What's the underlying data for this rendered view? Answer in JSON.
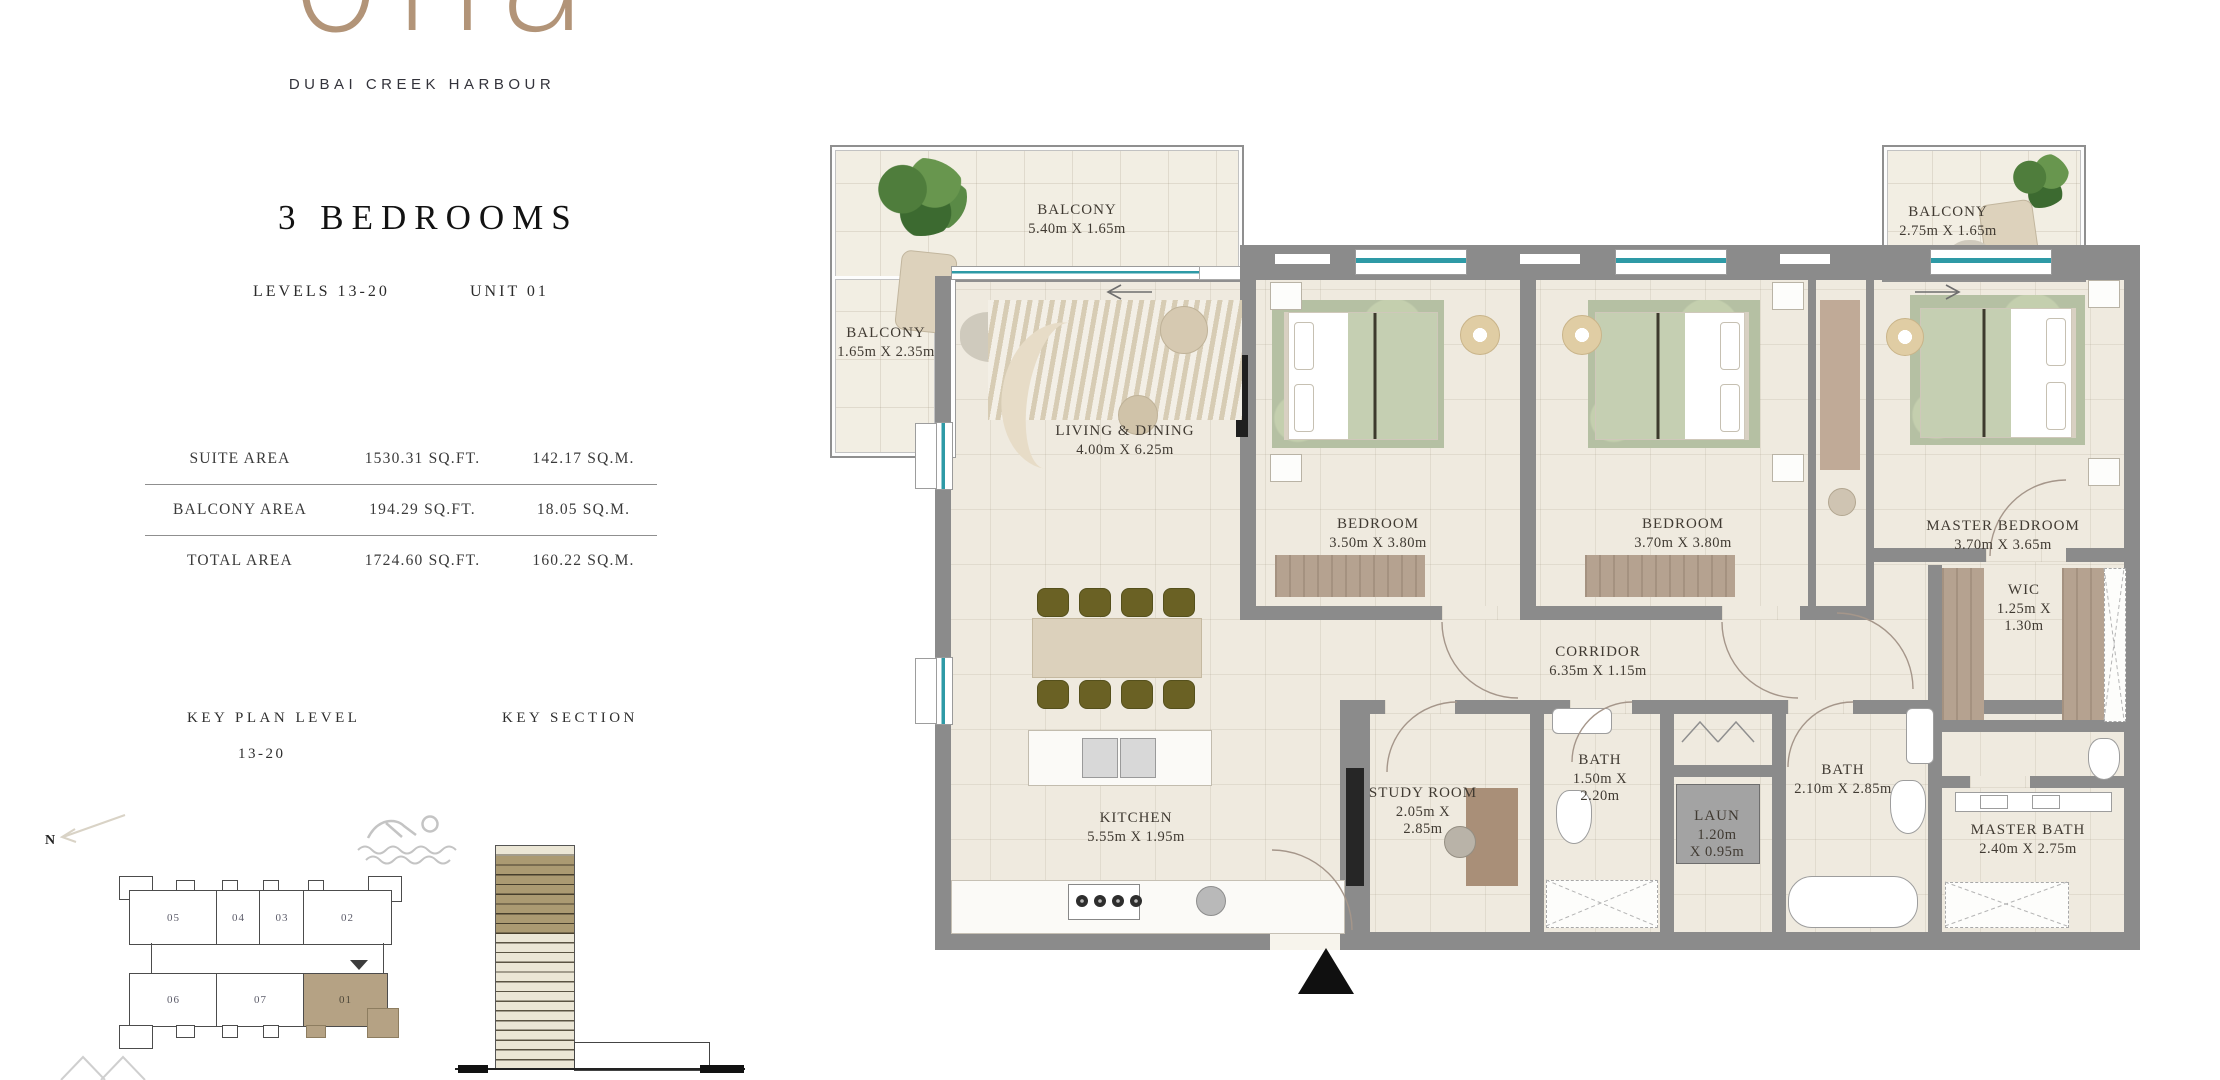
{
  "brand": {
    "logo_text": "ona",
    "subtitle": "DUBAI CREEK HARBOUR",
    "logo_color": "#b29478"
  },
  "unit_info": {
    "title": "3 BEDROOMS",
    "levels": "LEVELS 13-20",
    "unit": "UNIT 01"
  },
  "area_table": {
    "rows": [
      {
        "label": "SUITE AREA",
        "sqft": "1530.31 SQ.FT.",
        "sqm": "142.17 SQ.M."
      },
      {
        "label": "BALCONY AREA",
        "sqft": "194.29 SQ.FT.",
        "sqm": "18.05 SQ.M."
      },
      {
        "label": "TOTAL AREA",
        "sqft": "1724.60 SQ.FT.",
        "sqm": "160.22 SQ.M."
      }
    ]
  },
  "key_plan": {
    "title": "KEY PLAN LEVEL",
    "level_range": "13-20",
    "units": [
      "05",
      "04",
      "03",
      "02",
      "06",
      "07",
      "01"
    ],
    "highlighted_unit": "01",
    "highlight_color": "#b5a284"
  },
  "key_section": {
    "title": "KEY SECTION",
    "highlight_color": "#ab9a72"
  },
  "compass": {
    "north_label": "N"
  },
  "floorplan": {
    "wall_color": "#8b8b8b",
    "glazing_color": "#2e9aa6",
    "rooms": {
      "balcony_main": {
        "name": "BALCONY",
        "dims": "5.40m X 1.65m"
      },
      "balcony_side": {
        "name": "BALCONY",
        "dims": "1.65m X 2.35m"
      },
      "balcony_master": {
        "name": "BALCONY",
        "dims": "2.75m X 1.65m"
      },
      "living_dining": {
        "name": "LIVING & DINING",
        "dims": "4.00m X 6.25m"
      },
      "bedroom_1": {
        "name": "BEDROOM",
        "dims": "3.50m X 3.80m"
      },
      "bedroom_2": {
        "name": "BEDROOM",
        "dims": "3.70m X 3.80m"
      },
      "master_bedroom": {
        "name": "MASTER BEDROOM",
        "dims": "3.70m X 3.65m"
      },
      "wic": {
        "name": "WIC",
        "dims": "1.25m X\n1.30m"
      },
      "corridor": {
        "name": "CORRIDOR",
        "dims": "6.35m X 1.15m"
      },
      "study_room": {
        "name": "STUDY ROOM",
        "dims": "2.05m X\n2.85m"
      },
      "kitchen": {
        "name": "KITCHEN",
        "dims": "5.55m X 1.95m"
      },
      "bath_1": {
        "name": "BATH",
        "dims": "1.50m X\n2.20m"
      },
      "bath_2": {
        "name": "BATH",
        "dims": "2.10m X 2.85m"
      },
      "laundry": {
        "name": "LAUN",
        "dims": "1.20m\nX 0.95m"
      },
      "master_bath": {
        "name": "MASTER BATH",
        "dims": "2.40m X 2.75m"
      }
    }
  }
}
